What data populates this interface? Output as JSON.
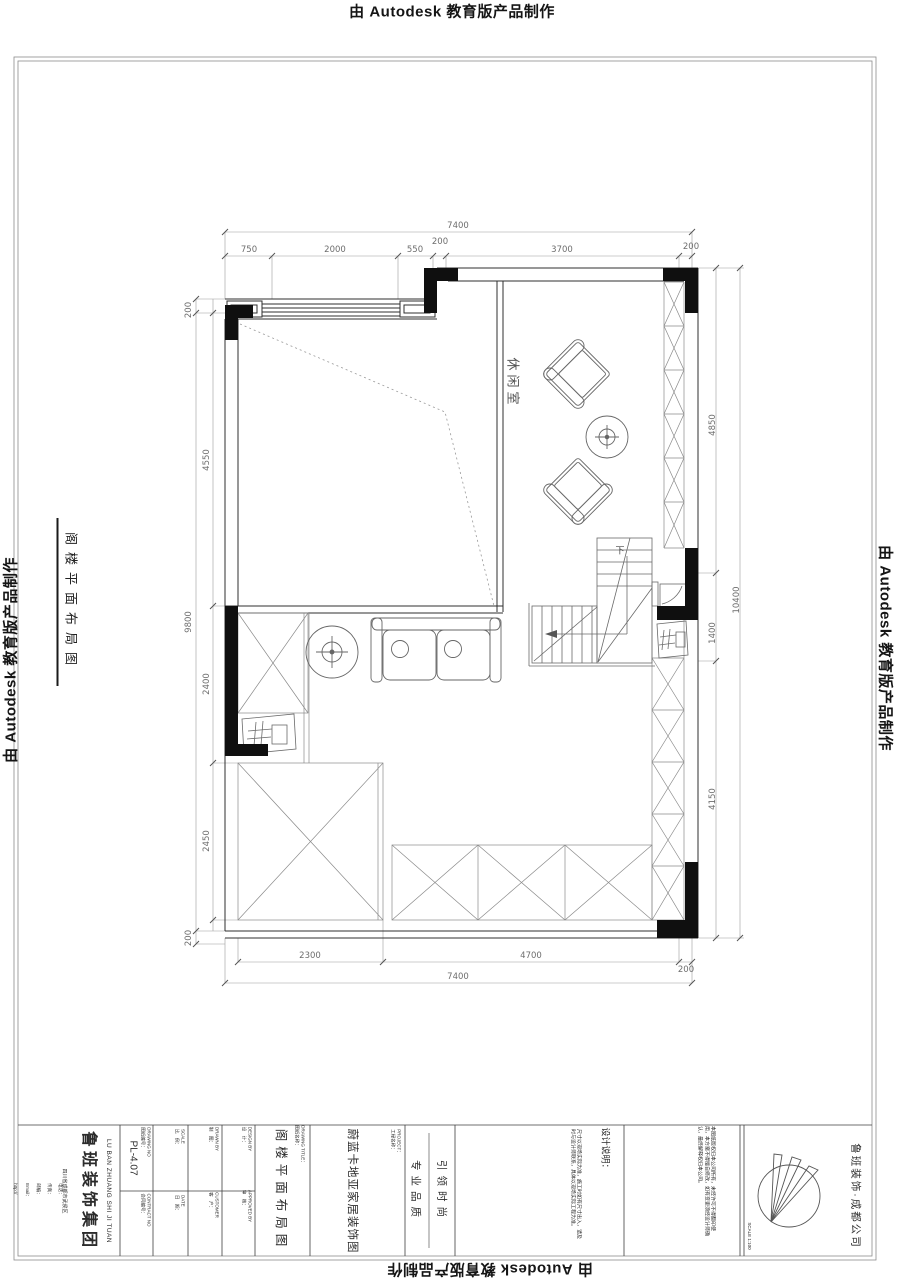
{
  "watermark": {
    "text": "由 Autodesk 教育版产品制作"
  },
  "side_label": {
    "text": "阁楼平面布局图"
  },
  "plan": {
    "room_label": "休闲室",
    "stair_label": "下",
    "dims": {
      "top_total": "7400",
      "top_segments": [
        "750",
        "2000",
        "550",
        "200",
        "3700",
        "200"
      ],
      "left_outer": [
        "200",
        "9800",
        "200"
      ],
      "left_inner": [
        "4550",
        "2400",
        "2450"
      ],
      "right_inner": [
        "4850",
        "1400",
        "4150"
      ],
      "right_outer": "10400",
      "bottom_segments": [
        "2300",
        "4700",
        "200"
      ],
      "bottom_total": "7400"
    }
  },
  "titleblock": {
    "company_en": "LU BAN ZHUANG SHI JI TUAN",
    "company_cn": "鲁班装饰集团",
    "company_address": "四川省成都市武侯区",
    "contact_lines": [
      "电话：",
      "传真：",
      "邮编：",
      "Email：",
      "http://"
    ],
    "drawing_no_label": "DRAWING NO\n图纸编号：",
    "drawing_no": "PL-4.07",
    "contract_label": "CONTRACT NO\n合同编号：",
    "scale_label": "SCALE\n比　例：",
    "date_label": "DATE\n日　期：",
    "drawn_label": "DRAWN BY\n制　图：",
    "customer_label": "CUSTOMER\n客　户：",
    "design_label": "DESIGN BY\n设　计：",
    "approved_label": "APPROVED BY\n审　核：",
    "title_label": "DRAWING TITLE：\n图纸名称：",
    "drawing_title": "阁楼平面布局图",
    "project_label": "PROJECT：\n工程名称：",
    "project_name": "蔚蓝卡地亚家居装饰图",
    "slogan_1": "专业品质",
    "slogan_2": "引领时尚",
    "notes_title": "设计说明：",
    "notes_body": "尺寸以现场实际为准，施工时如有尺寸出入，请及时与设计师联系，具体以现场实际工程为准。",
    "notes_extra": "本图纸版权归本公司所有，未经许可不得翻印使用，本方案不得擅自修改，如有变更须经设计师确认，最终解释权归本公司。",
    "scale_note": "SCALE 1:100",
    "branch": "鲁班装饰·成都公司"
  }
}
